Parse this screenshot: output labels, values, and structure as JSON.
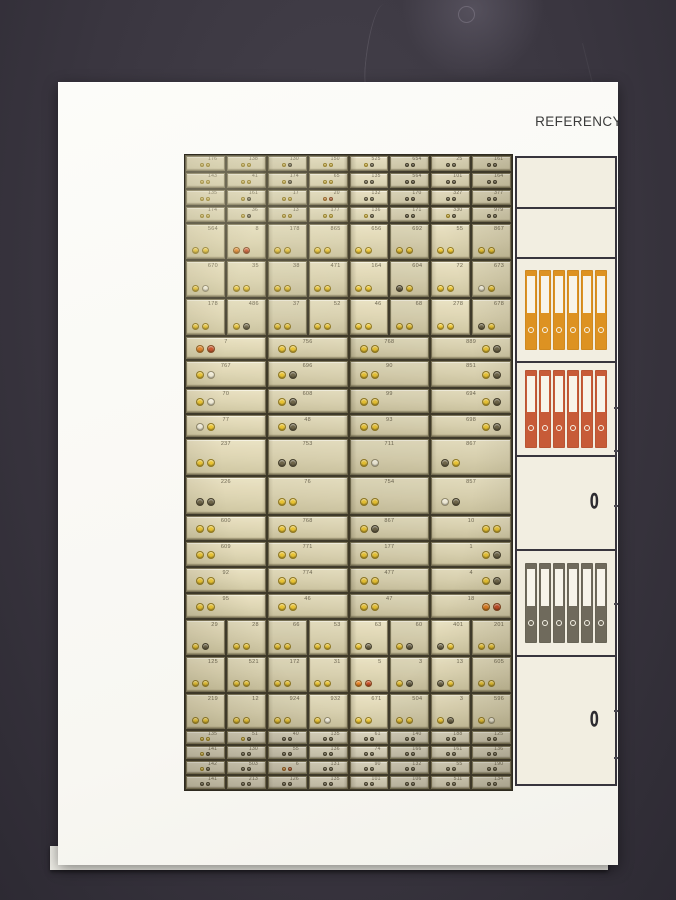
{
  "header": {
    "tab_label": "REFERENCY"
  },
  "photo": {
    "key_colors": {
      "y": "#e9c332",
      "d": "#6e6549",
      "o": "#e07f23",
      "r": "#c44d26",
      "w": "#ece7d3",
      "g": "#b3922f"
    },
    "sections": [
      {
        "type": "mini",
        "heights": [
          15,
          15,
          15,
          15
        ],
        "rows": [
          {
            "cells": [
              {
                "l": "176",
                "k": "yy"
              },
              {
                "l": "138",
                "k": "yy"
              },
              {
                "l": "130",
                "k": "yd"
              },
              {
                "l": "150",
                "k": "yy"
              },
              {
                "l": "525",
                "k": "yd"
              },
              {
                "l": "654",
                "k": "dd"
              },
              {
                "l": "25",
                "k": "dd"
              },
              {
                "l": "161",
                "k": "dd"
              }
            ]
          },
          {
            "cells": [
              {
                "l": "143",
                "k": "yy"
              },
              {
                "l": "41",
                "k": "yy"
              },
              {
                "l": "174",
                "k": "yd"
              },
              {
                "l": "65",
                "k": "yy"
              },
              {
                "l": "135",
                "k": "dd"
              },
              {
                "l": "564",
                "k": "dd"
              },
              {
                "l": "101",
                "k": "dd"
              },
              {
                "l": "164",
                "k": "dd"
              }
            ]
          },
          {
            "cells": [
              {
                "l": "135",
                "k": "yy"
              },
              {
                "l": "161",
                "k": "yd"
              },
              {
                "l": "17",
                "k": "yy"
              },
              {
                "l": "20",
                "k": "or"
              },
              {
                "l": "132",
                "k": "dd"
              },
              {
                "l": "170",
                "k": "dd"
              },
              {
                "l": "327",
                "k": "dd"
              },
              {
                "l": "377",
                "k": "dd"
              }
            ]
          },
          {
            "cells": [
              {
                "l": "174",
                "k": "yy"
              },
              {
                "l": "36",
                "k": "yd"
              },
              {
                "l": "13",
                "k": "yy"
              },
              {
                "l": "177",
                "k": "yy"
              },
              {
                "l": "136",
                "k": "yd"
              },
              {
                "l": "171",
                "k": "dd"
              },
              {
                "l": "330",
                "k": "yd"
              },
              {
                "l": "979",
                "k": "dd"
              }
            ]
          }
        ]
      },
      {
        "type": "med",
        "heights": [
          35,
          36,
          36
        ],
        "rows": [
          {
            "cells": [
              {
                "l": "564",
                "k": "yy"
              },
              {
                "l": "8",
                "k": "or"
              },
              {
                "l": "178",
                "k": "yy"
              },
              {
                "l": "865",
                "k": "yy"
              },
              {
                "l": "656",
                "k": "yy"
              },
              {
                "l": "692",
                "k": "yy"
              },
              {
                "l": "55",
                "k": "yy"
              },
              {
                "l": "867",
                "k": "yy"
              }
            ]
          },
          {
            "cells": [
              {
                "l": "670",
                "k": "yw"
              },
              {
                "l": "35",
                "k": "yy"
              },
              {
                "l": "38",
                "k": "yy"
              },
              {
                "l": "471",
                "k": "yy"
              },
              {
                "l": "164",
                "k": "yy"
              },
              {
                "l": "604",
                "k": "dy"
              },
              {
                "l": "72",
                "k": "yy"
              },
              {
                "l": "673",
                "k": "wy"
              }
            ]
          },
          {
            "cells": [
              {
                "l": "178",
                "k": "yy"
              },
              {
                "l": "486",
                "k": "yd"
              },
              {
                "l": "37",
                "k": "yy"
              },
              {
                "l": "52",
                "k": "yy"
              },
              {
                "l": "46",
                "k": "yy"
              },
              {
                "l": "68",
                "k": "yy"
              },
              {
                "l": "278",
                "k": "yy"
              },
              {
                "l": "678",
                "k": "dy"
              }
            ]
          }
        ]
      },
      {
        "type": "wide",
        "heights": [
          22,
          26,
          24,
          22
        ],
        "rows": [
          {
            "cells": [
              {
                "l": "7",
                "k": "or"
              },
              {
                "l": "756",
                "k": "yy"
              },
              {
                "l": "768",
                "k": "yy"
              },
              {
                "l": "889",
                "k": "yd",
                "kp": "right"
              }
            ]
          },
          {
            "cells": [
              {
                "l": "767",
                "k": "yw"
              },
              {
                "l": "696",
                "k": "yd"
              },
              {
                "l": "90",
                "k": "yy"
              },
              {
                "l": "851",
                "k": "yd",
                "kp": "right"
              }
            ]
          },
          {
            "cells": [
              {
                "l": "70",
                "k": "yw"
              },
              {
                "l": "608",
                "k": "yd"
              },
              {
                "l": "99",
                "k": "yy"
              },
              {
                "l": "694",
                "k": "yd",
                "kp": "right"
              }
            ]
          },
          {
            "cells": [
              {
                "l": "77",
                "k": "wy"
              },
              {
                "l": "48",
                "k": "yd"
              },
              {
                "l": "93",
                "k": "yy"
              },
              {
                "l": "698",
                "k": "yd",
                "kp": "right"
              }
            ]
          }
        ]
      },
      {
        "type": "tall",
        "heights": [
          36,
          37
        ],
        "rows": [
          {
            "cells": [
              {
                "l": "237",
                "k": "yy"
              },
              {
                "l": "753",
                "k": "dd"
              },
              {
                "l": "711",
                "k": "yw"
              },
              {
                "l": "867",
                "k": "dy"
              }
            ]
          },
          {
            "cells": [
              {
                "l": "226",
                "k": "dd"
              },
              {
                "l": "76",
                "k": "yy"
              },
              {
                "l": "754",
                "k": "yy"
              },
              {
                "l": "857",
                "k": "wd"
              }
            ]
          }
        ]
      },
      {
        "type": "short",
        "heights": [
          24,
          24,
          24,
          24
        ],
        "rows": [
          {
            "cells": [
              {
                "l": "600",
                "k": "yy"
              },
              {
                "l": "768",
                "k": "yy"
              },
              {
                "l": "867",
                "k": "yd"
              },
              {
                "l": "10",
                "k": "yy",
                "kp": "right"
              }
            ]
          },
          {
            "cells": [
              {
                "l": "609",
                "k": "yy"
              },
              {
                "l": "771",
                "k": "yy"
              },
              {
                "l": "177",
                "k": "yy"
              },
              {
                "l": "1",
                "k": "yd",
                "kp": "right"
              }
            ]
          },
          {
            "cells": [
              {
                "l": "92",
                "k": "yy"
              },
              {
                "l": "774",
                "k": "yy"
              },
              {
                "l": "477",
                "k": "yy"
              },
              {
                "l": "4",
                "k": "yd",
                "kp": "right"
              }
            ]
          },
          {
            "cells": [
              {
                "l": "95",
                "k": "yy"
              },
              {
                "l": "46",
                "k": "yy"
              },
              {
                "l": "47",
                "k": "yy"
              },
              {
                "l": "18",
                "k": "or",
                "kp": "right"
              }
            ]
          }
        ]
      },
      {
        "type": "med",
        "heights": [
          35,
          35,
          35
        ],
        "rows": [
          {
            "cells": [
              {
                "l": "29",
                "k": "yd"
              },
              {
                "l": "28",
                "k": "yy"
              },
              {
                "l": "66",
                "k": "yy"
              },
              {
                "l": "53",
                "k": "yy"
              },
              {
                "l": "63",
                "k": "yd"
              },
              {
                "l": "60",
                "k": "yd"
              },
              {
                "l": "401",
                "k": "dy"
              },
              {
                "l": "201",
                "k": "yy"
              }
            ]
          },
          {
            "cells": [
              {
                "l": "125",
                "k": "yy"
              },
              {
                "l": "521",
                "k": "yy"
              },
              {
                "l": "172",
                "k": "yy"
              },
              {
                "l": "31",
                "k": "yy"
              },
              {
                "l": "5",
                "k": "or"
              },
              {
                "l": "3",
                "k": "yd"
              },
              {
                "l": "13",
                "k": "dy"
              },
              {
                "l": "605",
                "k": "yy"
              }
            ]
          },
          {
            "cells": [
              {
                "l": "219",
                "k": "yy"
              },
              {
                "l": "12",
                "k": "yy"
              },
              {
                "l": "924",
                "k": "yy"
              },
              {
                "l": "932",
                "k": "yw"
              },
              {
                "l": "671",
                "k": "yy"
              },
              {
                "l": "504",
                "k": "yy"
              },
              {
                "l": "3",
                "k": "yd"
              },
              {
                "l": "596",
                "k": "yw"
              }
            ]
          }
        ]
      },
      {
        "type": "mini",
        "cls": "dim",
        "heights": [
          13,
          13,
          13,
          13
        ],
        "rows": [
          {
            "cells": [
              {
                "l": "135",
                "k": "yy"
              },
              {
                "l": "51",
                "k": "yd"
              },
              {
                "l": "40",
                "k": "dd"
              },
              {
                "l": "135",
                "k": "dd"
              },
              {
                "l": "61",
                "k": "dd"
              },
              {
                "l": "140",
                "k": "dd"
              },
              {
                "l": "188",
                "k": "dd"
              },
              {
                "l": "125",
                "k": "dd"
              }
            ]
          },
          {
            "cells": [
              {
                "l": "141",
                "k": "yd"
              },
              {
                "l": "130",
                "k": "dd"
              },
              {
                "l": "55",
                "k": "dd"
              },
              {
                "l": "136",
                "k": "dd"
              },
              {
                "l": "74",
                "k": "dd"
              },
              {
                "l": "166",
                "k": "dd"
              },
              {
                "l": "161",
                "k": "dd"
              },
              {
                "l": "136",
                "k": "dd"
              }
            ]
          },
          {
            "cells": [
              {
                "l": "142",
                "k": "yd"
              },
              {
                "l": "503",
                "k": "dd"
              },
              {
                "l": "6",
                "k": "or"
              },
              {
                "l": "131",
                "k": "dd"
              },
              {
                "l": "90",
                "k": "dd"
              },
              {
                "l": "132",
                "k": "dd"
              },
              {
                "l": "55",
                "k": "dd"
              },
              {
                "l": "190",
                "k": "dd"
              }
            ]
          },
          {
            "cells": [
              {
                "l": "141",
                "k": "dd"
              },
              {
                "l": "213",
                "k": "dd"
              },
              {
                "l": "126",
                "k": "dd"
              },
              {
                "l": "135",
                "k": "dd"
              },
              {
                "l": "101",
                "k": "dd"
              },
              {
                "l": "106",
                "k": "dd"
              },
              {
                "l": "511",
                "k": "dd"
              },
              {
                "l": "134",
                "k": "dd"
              }
            ]
          }
        ]
      }
    ]
  },
  "sidebar": {
    "rows": [
      {
        "type": "empty",
        "h": 51
      },
      {
        "type": "empty",
        "h": 50
      },
      {
        "type": "binders",
        "h": 104,
        "count": 6,
        "color": "#dd9222",
        "binder_h": 80
      },
      {
        "type": "binders",
        "h": 94,
        "count": 6,
        "color": "#c75b38",
        "binder_h": 78
      },
      {
        "type": "zero",
        "h": 94,
        "label": "0"
      },
      {
        "type": "binders",
        "h": 106,
        "count": 6,
        "color": "#6f6a5c",
        "binder_h": 80
      },
      {
        "type": "zero",
        "h": 127,
        "label": "0"
      }
    ]
  }
}
